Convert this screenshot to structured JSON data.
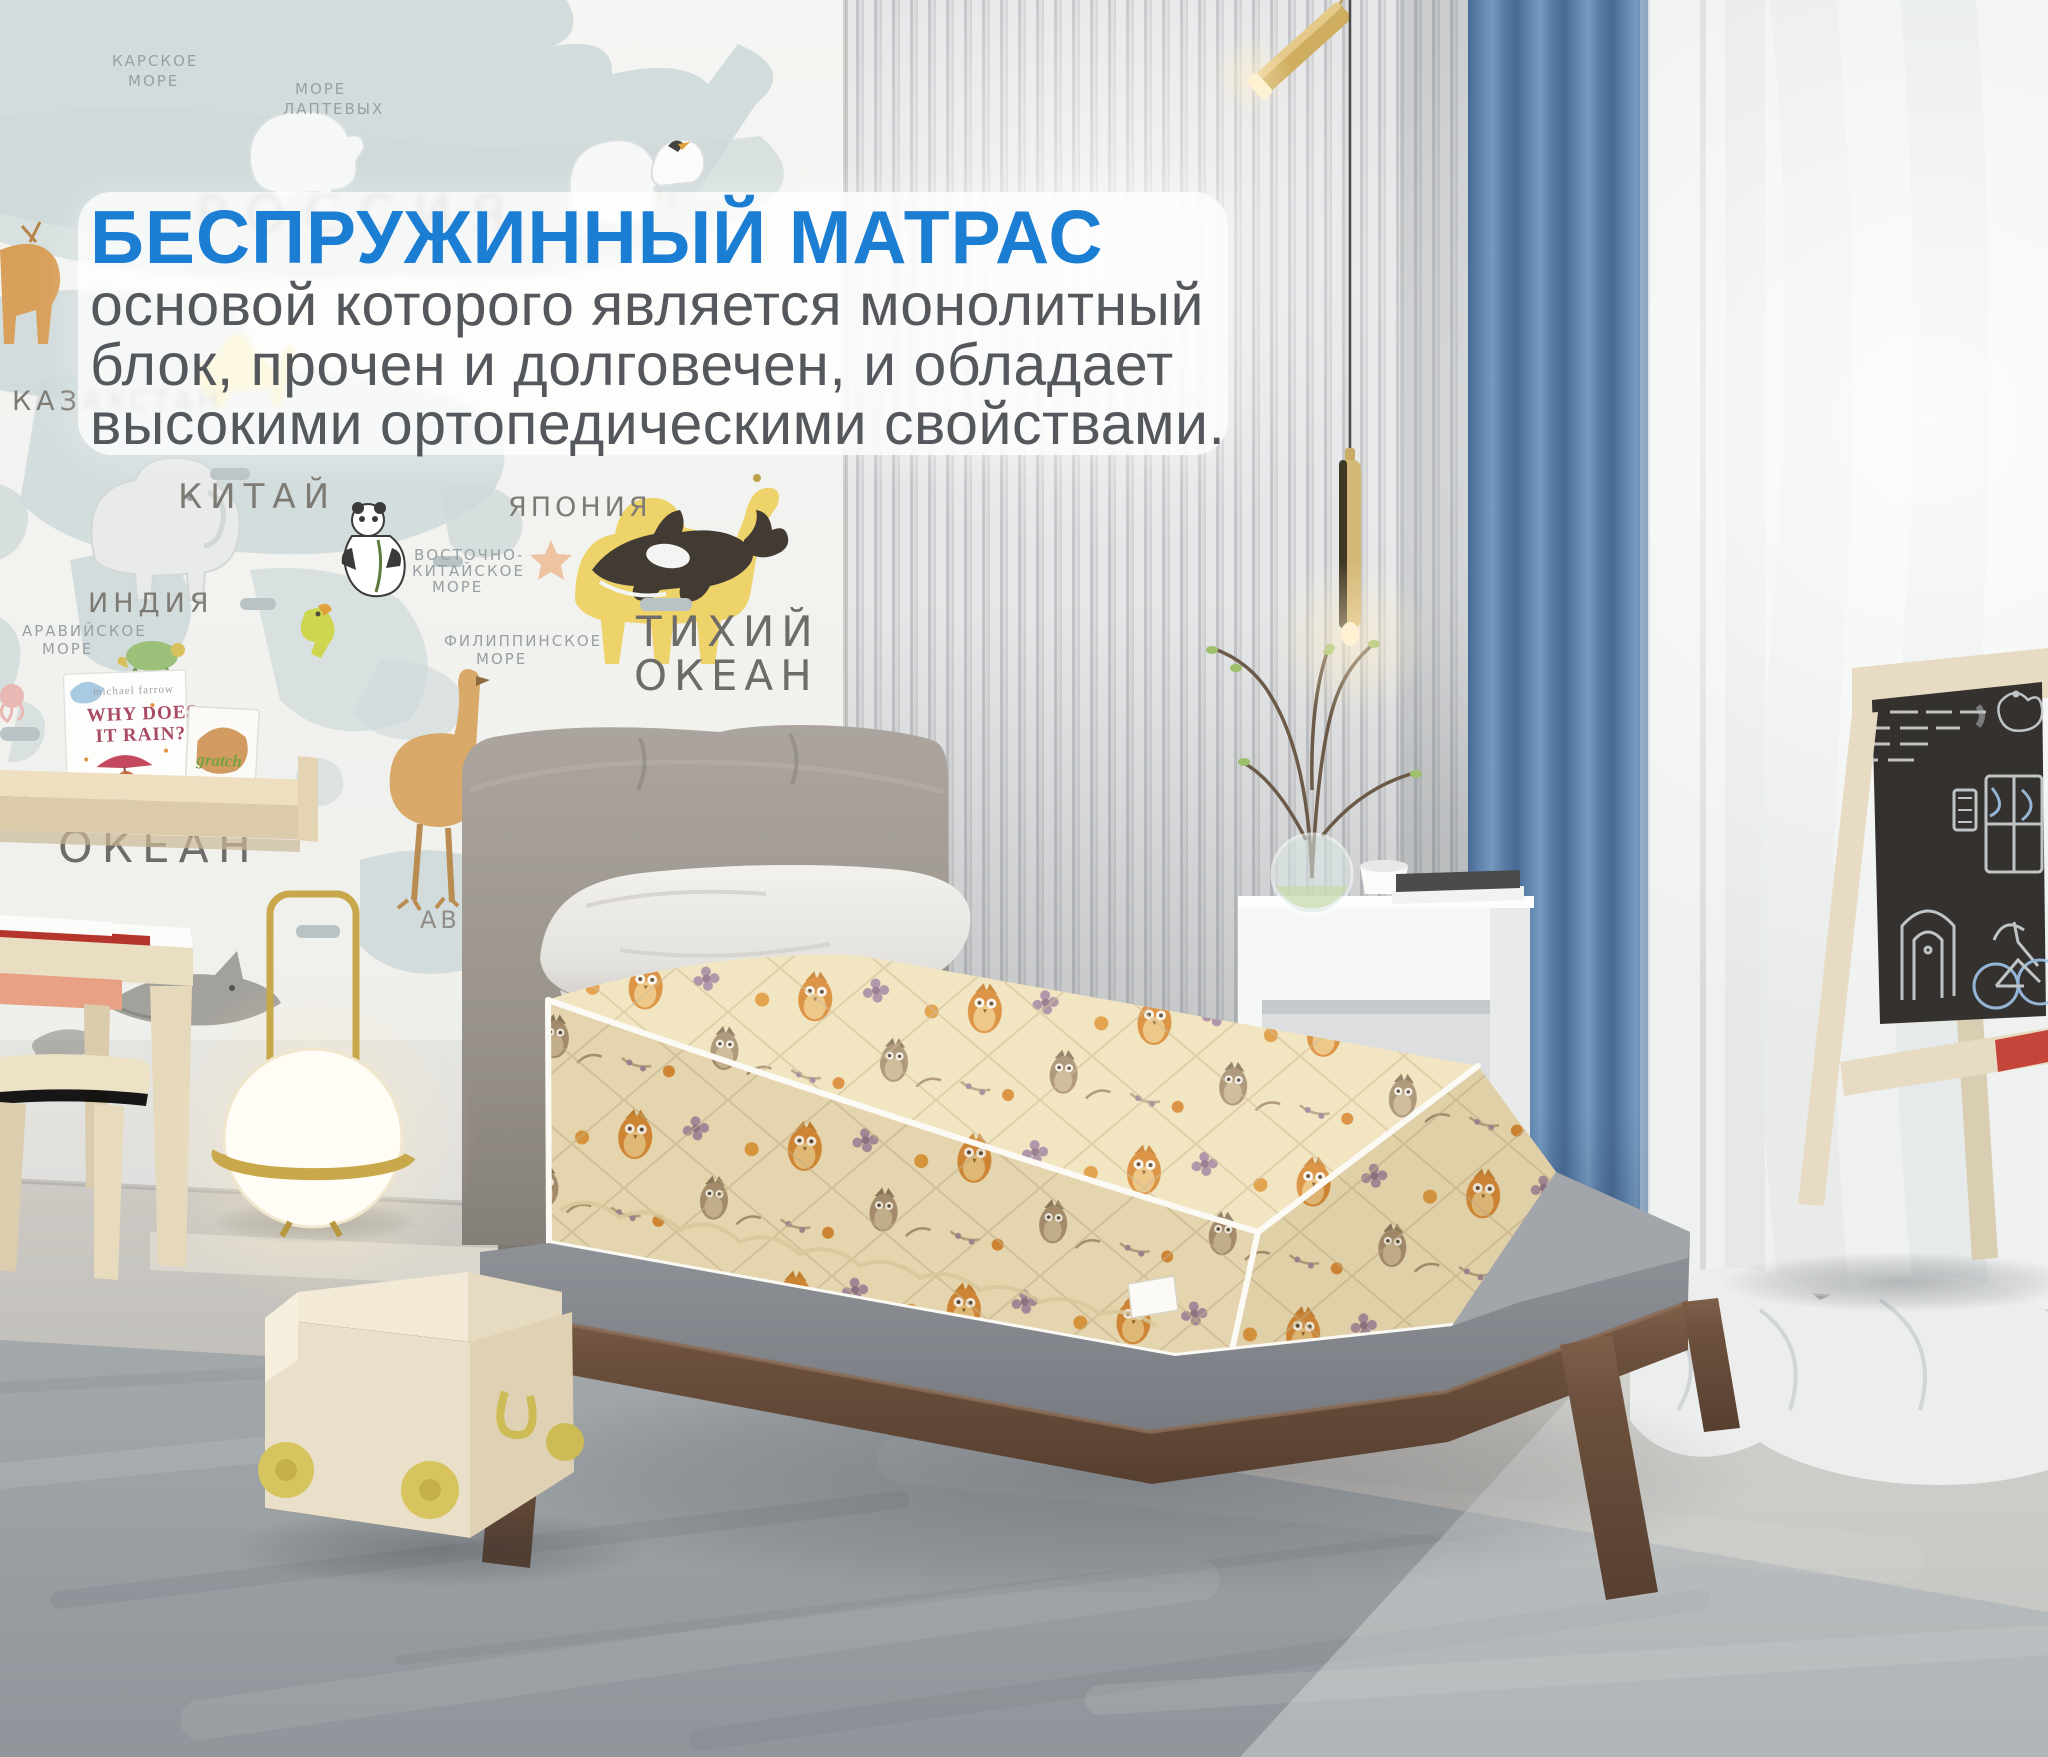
{
  "overlay": {
    "heading": "БЕСПРУЖИННЫЙ МАТРАС",
    "lines": [
      "основой которого является монолитный",
      "блок, прочен и долговечен, и обладает",
      "высокими ортопедическими свойствами."
    ]
  },
  "map": {
    "kara_sea_1": "КАРСКОЕ",
    "kara_sea_2": "МОРЕ",
    "laptev_sea_1": "МОРЕ",
    "laptev_sea_2": "ЛАПТЕВЫХ",
    "russia": "РОССИЯ",
    "kazakhstan": "КАЗАХСТАН",
    "china": "КИТАЙ",
    "japan": "ЯПОНИЯ",
    "india": "ИНДИЯ",
    "arabian_sea_1": "АРАВИЙСКОЕ",
    "arabian_sea_2": "МОРЕ",
    "east_china_sea_1": "ВОСТОЧНО-",
    "east_china_sea_2": "КИТАЙСКОЕ",
    "east_china_sea_3": "МОРЕ",
    "philippine_sea_1": "ФИЛИППИНСКОЕ",
    "philippine_sea_2": "МОРЕ",
    "pacific_1": "ТИХИЙ",
    "pacific_2": "ОКЕАН",
    "indian_ocean_edge": "ИНД",
    "ocean_big": "ОКЕАН",
    "australia_partial": "АВС"
  },
  "shelf_books": {
    "book1_author": "michael farrow",
    "book1_title_1": "WHY DOES",
    "book1_title_2": "IT RAIN?",
    "book2_title": "gratch"
  },
  "colors": {
    "accent_blue": "#1b7ed3",
    "body_text": "#54575b",
    "panel_bg": "rgba(255,255,255,0.8)",
    "curtain_blue": "#5e83ad",
    "mattress_cream": "#f1e3bb",
    "owl_orange": "#d98a33",
    "bed_wood": "#6d513e",
    "headboard_gray": "#9a948d",
    "wall_slat_gray": "#cdcfd1",
    "floor_gray": "#9ba0a4",
    "cart_wood": "#e8dcc2",
    "wheel_yellow": "#d6c45e"
  }
}
